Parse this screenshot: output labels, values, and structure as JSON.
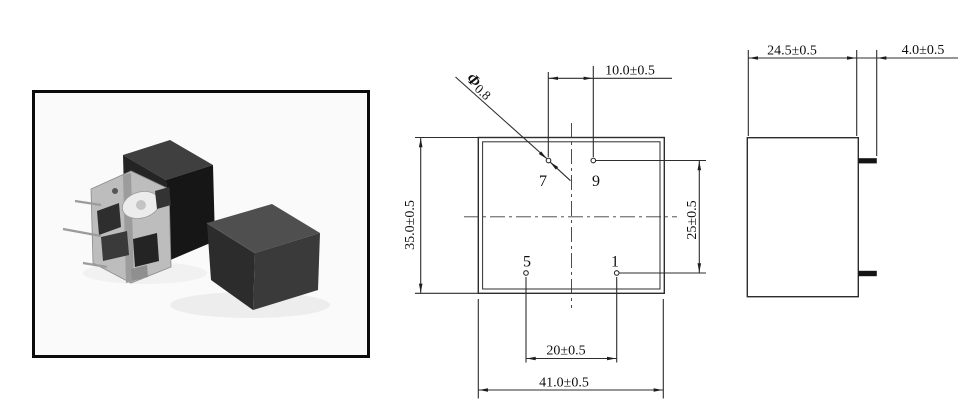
{
  "colors": {
    "drawing_line": "#2d2d2d",
    "text": "#101010",
    "photo_frame": "#0b0b0b",
    "photo_background": "#fafafa",
    "relay_body_dark": "#1b1b1b",
    "relay_body_top": "#4f4f4f"
  },
  "top_view": {
    "pins": {
      "p7": "7",
      "p9": "9",
      "p5": "5",
      "p1": "1"
    },
    "dims": {
      "top_hole_spacing": "10.0±0.5",
      "body_height": "35.0±0.5",
      "row_spacing": "25±0.5",
      "bottom_hole_spacing": "20±0.5",
      "body_width": "41.0±0.5",
      "pin_diameter_symbol": "Φ",
      "pin_diameter_value": "0.8"
    }
  },
  "side_view": {
    "dims": {
      "body_depth": "24.5±0.5",
      "pin_length": "4.0±0.5"
    }
  }
}
